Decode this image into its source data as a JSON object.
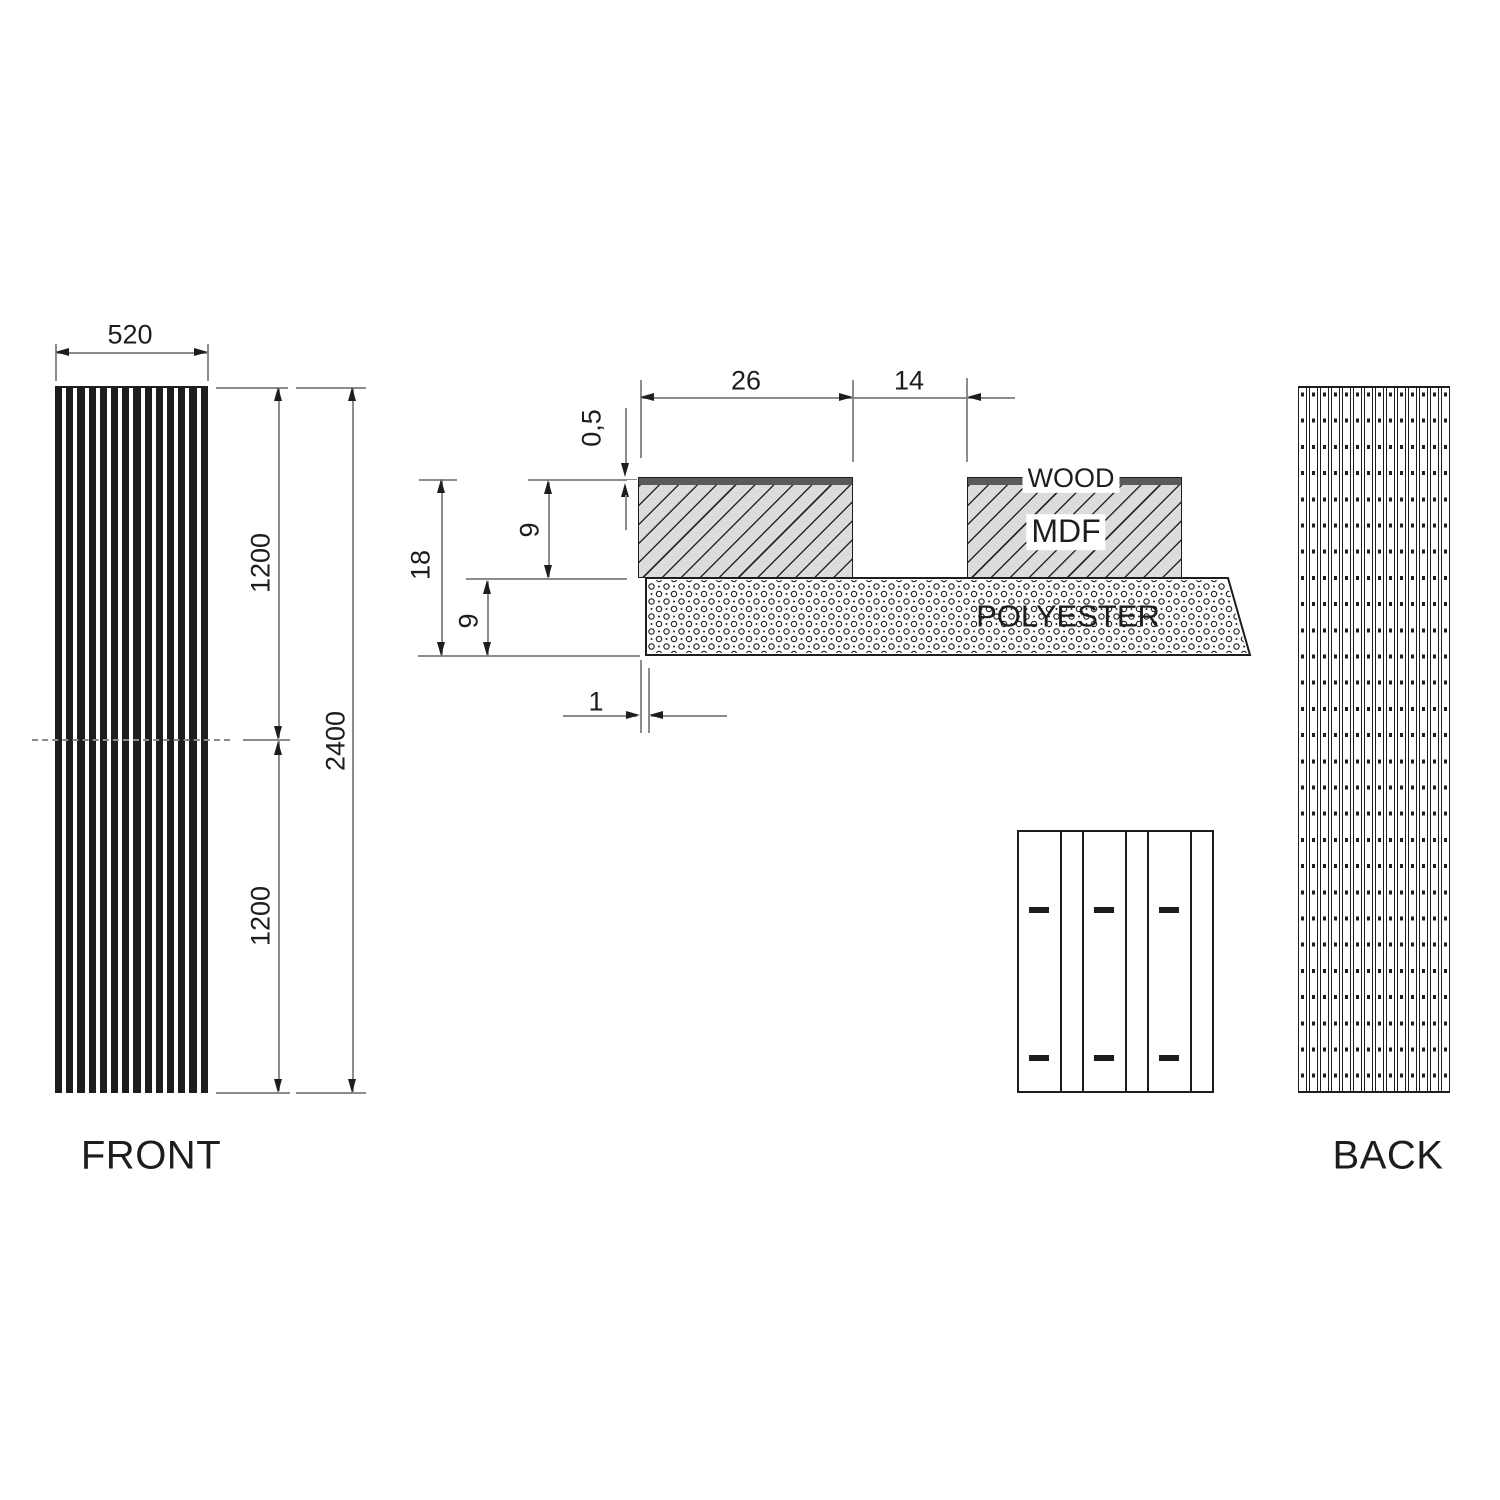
{
  "colors": {
    "background": "#ffffff",
    "ink": "#1d1d1b",
    "dim_line": "#8c8c8c",
    "mdf_fill": "#dcdcdc",
    "wood_veneer": "#5a5a5a"
  },
  "front_view": {
    "label": "FRONT",
    "slat_count": 14,
    "dims": {
      "width": "520",
      "upper_segment": "1200",
      "lower_segment": "1200",
      "total_height": "2400"
    }
  },
  "section_view": {
    "labels": {
      "wood": "WOOD",
      "mdf": "MDF",
      "polyester": "POLYESTER"
    },
    "dims": {
      "slat_width": "26",
      "slot_width": "14",
      "veneer_thickness": "0,5",
      "total_thickness": "18",
      "mdf_thickness": "9",
      "polyester_thickness": "9",
      "polyester_offset": "1"
    }
  },
  "detail_view": {
    "slat_count": 3,
    "dash_rows": 2
  },
  "back_view": {
    "label": "BACK",
    "slat_count": 14,
    "dash_rows": 27
  }
}
